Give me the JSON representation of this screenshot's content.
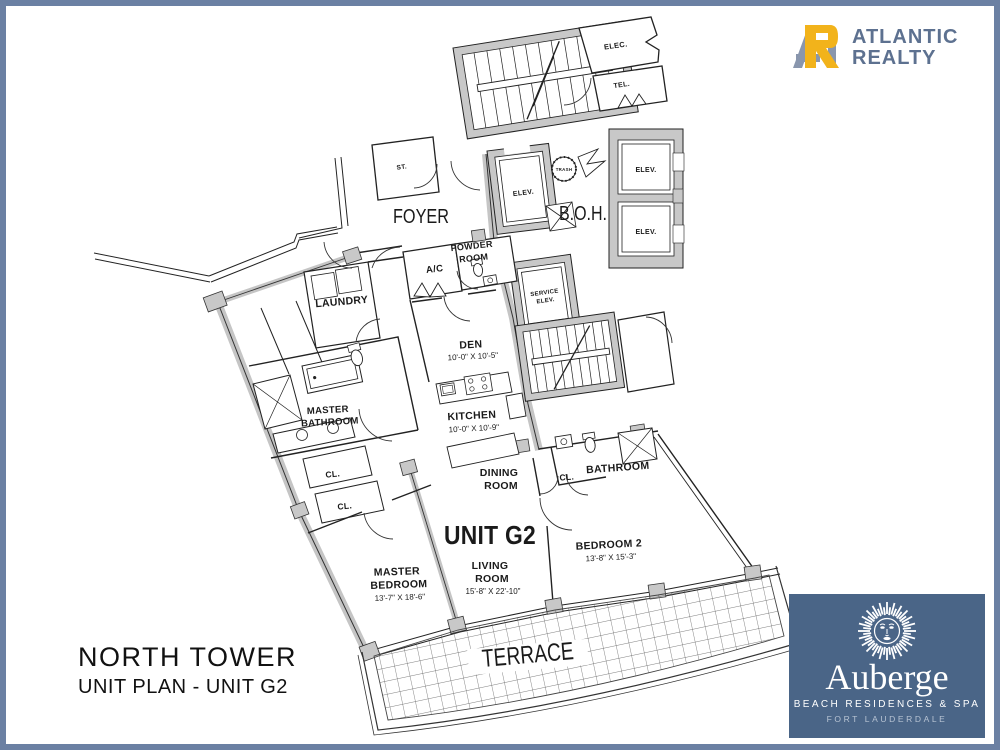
{
  "page": {
    "border_color": "#6b80a3",
    "background": "#ffffff",
    "plan_line_color": "#1a1a1a",
    "wall_fill_color": "#c8c8c8"
  },
  "brand": {
    "line1": "ATLANTIC",
    "line2": "REALTY",
    "text_color": "#5d7190",
    "icon_gold": "#f2b31b",
    "icon_gray": "#8996ad"
  },
  "title": {
    "line1": "NORTH TOWER",
    "line2": "UNIT PLAN - UNIT G2"
  },
  "auberge": {
    "name": "Auberge",
    "subtitle": "BEACH RESIDENCES & SPA",
    "city": "FORT LAUDERDALE",
    "bg_color": "#4a6587"
  },
  "plan": {
    "unit": "UNIT G2",
    "labels": {
      "foyer": "FOYER",
      "boh": "B.O.H.",
      "terrace": "TERRACE",
      "elec": "ELEC.",
      "tel": "TEL.",
      "st": "ST.",
      "elev": "ELEV.",
      "trash": "TRASH",
      "service1": "SERVICE",
      "service2": "ELEV.",
      "powder1": "POWDER",
      "powder2": "ROOM",
      "ac": "A/C",
      "laundry": "LAUNDRY",
      "den": "DEN",
      "den_dim": "10'-0\" X 10'-5\"",
      "kitchen": "KITCHEN",
      "kitchen_dim": "10'-0\" X 10'-9\"",
      "mbath1": "MASTER",
      "mbath2": "BATHROOM",
      "cl": "CL.",
      "dining1": "DINING",
      "dining2": "ROOM",
      "bathroom": "BATHROOM",
      "unitg2": "UNIT G2",
      "living1": "LIVING",
      "living2": "ROOM",
      "living_dim": "15'-8\" X 22'-10\"",
      "mbed1": "MASTER",
      "mbed2": "BEDROOM",
      "mbed_dim": "13'-7\" X 18'-6\"",
      "bed2": "BEDROOM 2",
      "bed2_dim": "13'-8\" X 15'-3\""
    }
  }
}
